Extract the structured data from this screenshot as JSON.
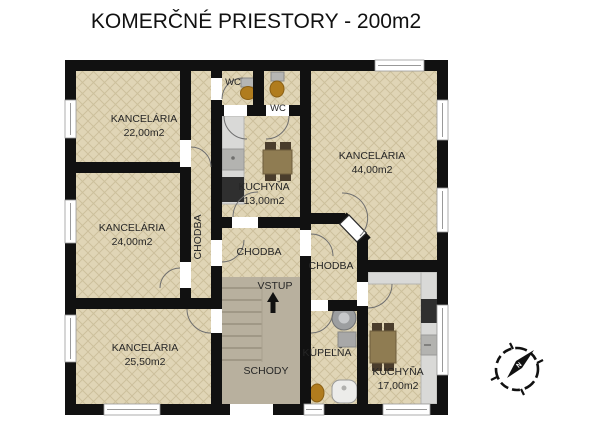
{
  "title": "KOMERČNÉ PRIESTORY - 200m2",
  "rooms": {
    "office1": {
      "name": "KANCELÁRIA",
      "area": "22,00m2"
    },
    "office2": {
      "name": "KANCELÁRIA",
      "area": "24,00m2"
    },
    "office3": {
      "name": "KANCELÁRIA",
      "area": "25,50m2"
    },
    "office4": {
      "name": "KANCELÁRIA",
      "area": "44,00m2"
    },
    "kitchen_small": {
      "name": "KUCHYŇA",
      "area": "13,00m2"
    },
    "kitchen_large": {
      "name": "KUCHYŇA",
      "area": "17,00m2"
    },
    "bathroom": {
      "name": "KÚPEĽŇA"
    },
    "wc1": {
      "name": "WC"
    },
    "wc2": {
      "name": "WC"
    },
    "hall_west": {
      "name": "CHODBA"
    },
    "hall_center": {
      "name": "CHODBA"
    },
    "hall_east": {
      "name": "CHODBA"
    },
    "entrance": {
      "name": "VSTUP"
    },
    "stairs": {
      "name": "SCHODY"
    }
  },
  "compass": {
    "north": "N"
  },
  "colors": {
    "wall": "#111111",
    "floor": "#e0d5b6",
    "floor_hatch": "#cdc09c",
    "stairs_floor": "#b8b09e",
    "counter": "#d9d9d7",
    "appliance_dark": "#2f2f2f",
    "wood": "#8f7c52",
    "chair_wood": "#4a3d2c",
    "fixture_brown": "#b07c1e",
    "fixture_gray": "#a8a8a8"
  }
}
